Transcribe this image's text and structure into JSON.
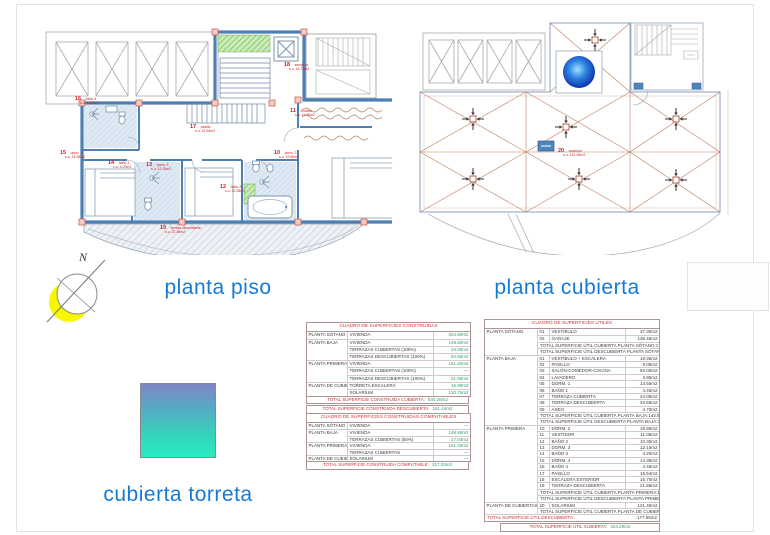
{
  "titles": {
    "plan_left": "planta piso",
    "plan_right": "planta cubierta",
    "legend": "cubierta torreta",
    "compass": "N"
  },
  "plans": {
    "left": {
      "labels": [
        {
          "num": "16",
          "name": "baño 4",
          "area": "s.u. 4.45m2",
          "_x": 43,
          "_y": 84
        },
        {
          "num": "15",
          "name": "dorm. 4",
          "area": "s.u. 14.35m2",
          "_x": 28,
          "_y": 138
        },
        {
          "num": "14",
          "name": "baño 3",
          "area": "s.u. 4.20m2",
          "_x": 76,
          "_y": 148
        },
        {
          "num": "13",
          "name": "dorm. 3",
          "area": "s.u. 12.15m2",
          "_x": 114,
          "_y": 150
        },
        {
          "num": "17",
          "name": "pasillo",
          "area": "s.u. 15.54m2",
          "_x": 158,
          "_y": 112
        },
        {
          "num": "12",
          "name": "baño 2",
          "area": "s.u. 10.35m2",
          "_x": 188,
          "_y": 172
        },
        {
          "num": "10",
          "name": "dorm. 2",
          "area": "s.u. 19.80m2",
          "_x": 242,
          "_y": 138
        },
        {
          "num": "11",
          "name": "vestidor",
          "area": "s.u. 11.05m2",
          "_x": 258,
          "_y": 96
        },
        {
          "num": "18",
          "name": "escalera",
          "area": "s.u. 15.70m2",
          "_x": 252,
          "_y": 50
        },
        {
          "num": "19",
          "name": "terraza descubierta",
          "area": "s.u. 21.55m2",
          "_x": 128,
          "_y": 213
        }
      ]
    },
    "right": {
      "labels": [
        {
          "num": "20",
          "name": "solarium",
          "area": "s.u. 121.45m2",
          "_x": 160,
          "_y": 131
        }
      ]
    }
  },
  "tables": {
    "construidas": {
      "title": "CUADRO DE SUPERFICIES CONSTRUIDAS",
      "rows": [
        {
          "planta": "PLANTA SÓTANO",
          "concepto": "VIVIENDA",
          "valor": "204.80m2",
          "cls": "sec"
        },
        {
          "planta": "PLANTA BAJA",
          "concepto": "VIVIENDA",
          "valor": "148.80m2",
          "cls": "sec"
        },
        {
          "planta": "",
          "concepto": "TERRAZAS CUBIERTAS (100%)",
          "valor": "34.05m2"
        },
        {
          "planta": "",
          "concepto": "TERRAZAS DESCUBIERTAS (100%)",
          "valor": "84.55m2"
        },
        {
          "planta": "PLANTA PRIMERA",
          "concepto": "VIVIENDA",
          "valor": "151.20m2",
          "cls": "sec"
        },
        {
          "planta": "",
          "concepto": "TERRAZAS CUBIERTAS (100%)",
          "valor": "—"
        },
        {
          "planta": "",
          "concepto": "TERRAZAS DESCUBIERTAS (100%)",
          "valor": "21.55m2"
        },
        {
          "planta": "PLANTA DE CUBIERTAS",
          "concepto": "TORRETA ESCALERA",
          "valor": "15.90m2",
          "cls": "sec"
        },
        {
          "planta": "",
          "concepto": "SOLARIUM",
          "valor": "130.75m2"
        }
      ],
      "totals": [
        {
          "label": "TOTAL SUPERFICIE CONSTRUIDA CUBIERTA:",
          "valor": "540.26m2"
        },
        {
          "label": "TOTAL SUPERFICIE CONSTRUIDA DESCUBIERTA:",
          "valor": "191.44m2"
        }
      ]
    },
    "computables": {
      "title": "CUADRO DE SUPERFICIES CONSTRUIDAS COMPUTABLES",
      "rows": [
        {
          "planta": "PLANTA SÓTANO",
          "concepto": "VIVIENDA",
          "valor": "—",
          "cls": "sec"
        },
        {
          "planta": "PLANTA BAJA",
          "concepto": "VIVIENDA",
          "valor": "148.80m2",
          "cls": "sec"
        },
        {
          "planta": "",
          "concepto": "TERRAZAS CUBIERTAS (50%)",
          "valor": "17.03m2"
        },
        {
          "planta": "PLANTA PRIMERA",
          "concepto": "VIVIENDA",
          "valor": "151.20m2",
          "cls": "sec"
        },
        {
          "planta": "",
          "concepto": "TERRAZAS CUBIERTAS",
          "valor": "—"
        },
        {
          "planta": "PLANTA DE CUBIERTAS",
          "concepto": "SOLARIUM",
          "valor": "—",
          "cls": "sec"
        }
      ],
      "totals": [
        {
          "label": "TOTAL SUPERFICIE CONSTRUIDA COMPUTABLE:",
          "valor": "317.03m2"
        }
      ]
    },
    "utiles": {
      "title": "CUADRO DE SUPERFICIES ÚTILES",
      "rows": [
        {
          "planta": "PLANTA SÓTANO",
          "num": "01",
          "nombre": "VESTÍBULO",
          "valor": "37.30m2",
          "cls": "sec"
        },
        {
          "planta": "",
          "num": "02",
          "nombre": "GARAJE",
          "valor": "136.45m2"
        },
        {
          "total": "TOTAL SUPERFICIE ÚTIL CUBIERTA PLANTA SÓTANO:",
          "valor": "173.75m2",
          "cls": "total"
        },
        {
          "total": "TOTAL SUPERFICIE ÚTIL DESCUBIERTA PLANTA SÓTANO:",
          "valor": "—",
          "cls": "total"
        },
        {
          "planta": "PLANTA BAJA",
          "num": "01",
          "nombre": "VESTÍBULO + ESCALERA",
          "valor": "18.35m2",
          "cls": "sec"
        },
        {
          "planta": "",
          "num": "02",
          "nombre": "PASILLO",
          "valor": "9.05m2"
        },
        {
          "planta": "",
          "num": "03",
          "nombre": "SALÓN-COMEDOR-COCINA",
          "valor": "62.00m2"
        },
        {
          "planta": "",
          "num": "04",
          "nombre": "LAVADERO",
          "valor": "3.95m2"
        },
        {
          "planta": "",
          "num": "05",
          "nombre": "DORM. 1",
          "valor": "14.55m2"
        },
        {
          "planta": "",
          "num": "06",
          "nombre": "BAÑO 1",
          "valor": "4.45m2"
        },
        {
          "planta": "",
          "num": "07",
          "nombre": "TERRAZA CUBIERTA",
          "valor": "24.05m2"
        },
        {
          "planta": "",
          "num": "08",
          "nombre": "TERRAZA DESCUBIERTA",
          "valor": "34.55m2"
        },
        {
          "planta": "",
          "num": "09",
          "nombre": "ASEO",
          "valor": "4.70m2"
        },
        {
          "total": "TOTAL SUPERFICIE ÚTIL CUBIERTA PLANTA BAJA:",
          "valor": "142.80m2",
          "cls": "total"
        },
        {
          "total": "TOTAL SUPERFICIE ÚTIL DESCUBIERTA PLANTA BAJA:",
          "valor": "34.55m2",
          "cls": "total"
        },
        {
          "planta": "PLANTA PRIMERA",
          "num": "10",
          "nombre": "DORM. 2",
          "valor": "19.80m2",
          "cls": "sec"
        },
        {
          "planta": "",
          "num": "11",
          "nombre": "VESTIDOR",
          "valor": "11.05m2"
        },
        {
          "planta": "",
          "num": "12",
          "nombre": "BAÑO 2",
          "valor": "10.35m2"
        },
        {
          "planta": "",
          "num": "13",
          "nombre": "DORM. 3",
          "valor": "12.15m2"
        },
        {
          "planta": "",
          "num": "14",
          "nombre": "BAÑO 3",
          "valor": "4.20m2"
        },
        {
          "planta": "",
          "num": "15",
          "nombre": "DORM. 4",
          "valor": "14.35m2"
        },
        {
          "planta": "",
          "num": "16",
          "nombre": "BAÑO 4",
          "valor": "4.45m2"
        },
        {
          "planta": "",
          "num": "17",
          "nombre": "PASILLO",
          "valor": "15.54m2"
        },
        {
          "planta": "",
          "num": "18",
          "nombre": "ESCALERA EXTERIOR",
          "valor": "15.70m2"
        },
        {
          "planta": "",
          "num": "19",
          "nombre": "TERRAZA DESCUBIERTA",
          "valor": "21.55m2"
        },
        {
          "total": "TOTAL SUPERFICIE ÚTIL CUBIERTA PLANTA PRIMERA:",
          "valor": "107.74m2",
          "cls": "total"
        },
        {
          "total": "TOTAL SUPERFICIE ÚTIL DESCUBIERTA PLANTA PRIMERA:",
          "valor": "21.55m2",
          "cls": "total"
        },
        {
          "planta": "PLANTA DE CUBIERTAS",
          "num": "20",
          "nombre": "SOLARIUM",
          "valor": "121.45m2",
          "cls": "sec"
        },
        {
          "total": "TOTAL SUPERFICIE ÚTIL CUBIERTA PLANTA DE CUBIERTAS:",
          "valor": "—",
          "cls": "total"
        },
        {
          "total": "TOTAL SUPERFICIE ÚTIL DESCUBIERTA:",
          "valor": "177.55m2",
          "cls": "total grand"
        }
      ],
      "grand_total": {
        "label": "TOTAL SUPERFICIE ÚTIL CUBIERTA:",
        "valor": "424.29m2"
      }
    }
  }
}
